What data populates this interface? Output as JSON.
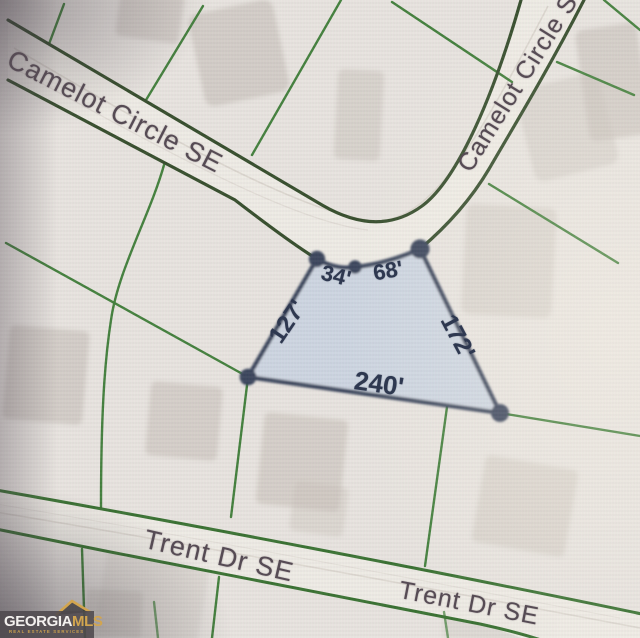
{
  "map": {
    "street_labels": [
      {
        "id": "camelot-upper-left",
        "text": "Camelot Circle SE"
      },
      {
        "id": "camelot-upper-right",
        "text": "Camelot Circle SE"
      },
      {
        "id": "trent-lower-left",
        "text": "Trent Dr SE"
      },
      {
        "id": "trent-lower-right",
        "text": "Trent Dr SE"
      }
    ],
    "parcel": {
      "dimension_labels": {
        "top_left": "34'",
        "top_right": "68'",
        "left": "127'",
        "right": "172'",
        "bottom": "240'"
      },
      "fill_color": "#c9d3df",
      "outline_color": "#333c55"
    },
    "colors": {
      "background": "#e7e3de",
      "lot_line_green": "#3a7a33",
      "road_edge_dark_green": "#2c4522",
      "trent_edge_green": "#306b28",
      "dimension_text": "#2e3850",
      "street_text": "#564b54"
    }
  },
  "watermark": {
    "brand_part1": "GEORGIA",
    "brand_part2": "MLS",
    "tagline": "REAL ESTATE SERVICES",
    "gold": "#d2a54f"
  }
}
